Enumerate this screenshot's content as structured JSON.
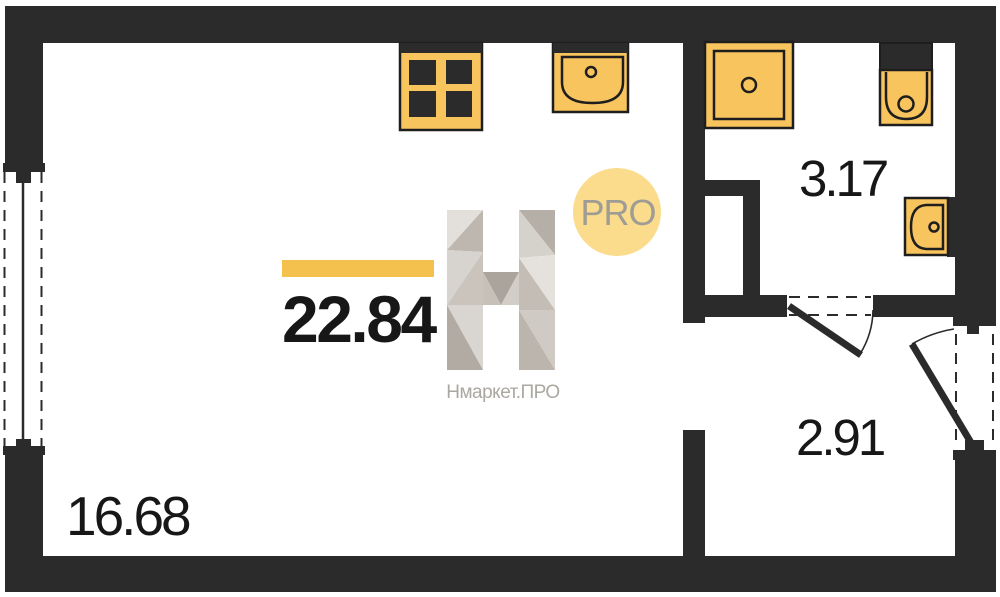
{
  "floor_plan": {
    "type": "studio-apartment-floor-plan",
    "areas": {
      "total": "22.84",
      "living_room": "16.68",
      "bathroom": "3.17",
      "hallway": "2.91"
    },
    "watermark": {
      "badge": "PRO",
      "brand": "Нмаркет.ПРО",
      "logo_palette": [
        "#e3e0dc",
        "#bdb7b0",
        "#d7d3ce",
        "#cac4bd",
        "#d9d5d0",
        "#b2aba3",
        "#b6afa7",
        "#d5d1cb",
        "#e5e2de",
        "#c3bdb6",
        "#cfcac4",
        "#bcb5ad",
        "#aba49c",
        "#c6c0b9",
        "#d2cdc7"
      ]
    },
    "colors": {
      "wall": "#2b2b2b",
      "fixture-fill": "#f8c45d",
      "fixture-stroke": "#1e1e1e",
      "accent-bar": "#f5c14e",
      "badge-fill": "#fadc8c",
      "badge-text": "#9e9c94",
      "brand-text": "#aba7a1",
      "label-text": "#171717",
      "background": "#ffffff"
    },
    "fixtures": [
      "stove-icon",
      "kitchen-sink-icon",
      "shower-icon",
      "toilet-icon",
      "washbasin-icon"
    ],
    "openings": [
      "window",
      "bathroom-door",
      "entrance-door",
      "passage"
    ]
  }
}
